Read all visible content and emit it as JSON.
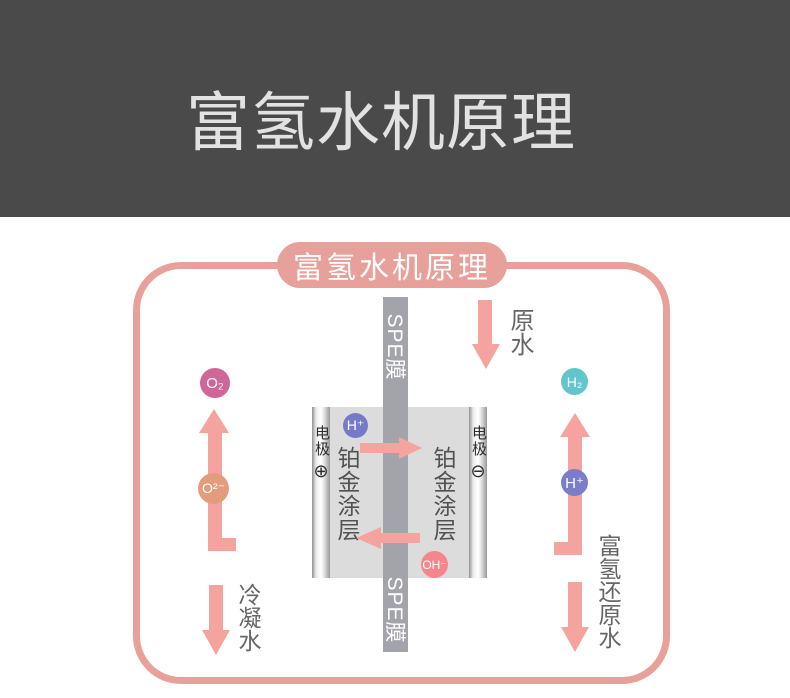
{
  "header": {
    "title": "富氢水机原理"
  },
  "diagram": {
    "badge_label": "富氢水机原理",
    "membrane": {
      "label_top": "SPE膜",
      "label_bottom": "SPE膜"
    },
    "cell": {
      "electrode_left": {
        "label": "电极",
        "polarity": "⊕"
      },
      "electrode_right": {
        "label": "电极",
        "polarity": "⊖"
      },
      "coating_left": "铂金涂层",
      "coating_right": "铂金涂层"
    },
    "particles": {
      "o2": {
        "label": "O₂",
        "color": "#d06597"
      },
      "o2minus": {
        "label": "O²⁻",
        "color": "#e39d7d"
      },
      "h_plus_left": {
        "label": "H⁺",
        "color": "#747ac8"
      },
      "h2": {
        "label": "H₂",
        "color": "#62c5cd"
      },
      "h_plus_right": {
        "label": "H⁺",
        "color": "#7a7dc9"
      },
      "oh_minus": {
        "label": "OH⁻",
        "color": "#f5868e"
      }
    },
    "flow_labels": {
      "raw_water": "原水",
      "condensed_water": "冷凝水",
      "hydrogen_rich_water": "富氢还原水"
    },
    "colors": {
      "header_bg": "#4a4a4a",
      "outline_pink": "#e8a09a",
      "arrow_pink": "#f5a39e",
      "membrane_gray": "#a3a3ab",
      "cell_gray": "#dcdcdc"
    }
  }
}
